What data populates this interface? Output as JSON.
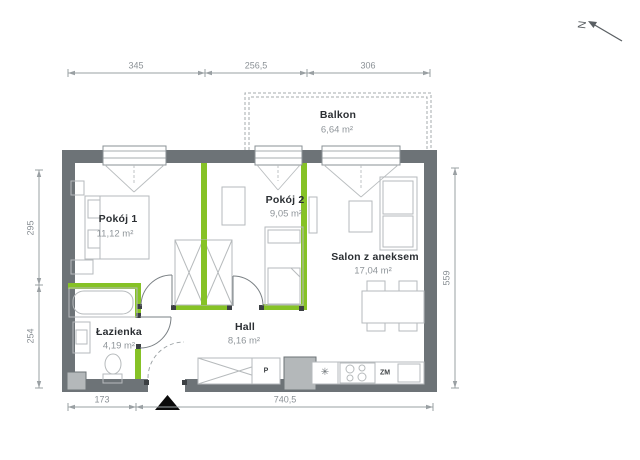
{
  "compass": {
    "label": "N"
  },
  "rooms": {
    "pokoj1": {
      "name": "Pokój 1",
      "area": "11,12 m²"
    },
    "pokoj2": {
      "name": "Pokój 2",
      "area": "9,05 m²"
    },
    "salon": {
      "name": "Salon z aneksem",
      "area": "17,04 m²"
    },
    "lazienka": {
      "name": "Łazienka",
      "area": "4,19 m²"
    },
    "hall": {
      "name": "Hall",
      "area": "8,16 m²"
    },
    "balkon": {
      "name": "Balkon",
      "area": "6,64 m²"
    }
  },
  "dimensions_cm": {
    "top": [
      "345",
      "256,5",
      "306"
    ],
    "left": [
      "295",
      "254"
    ],
    "right": [
      "559"
    ],
    "bottom": [
      "173",
      "740,5"
    ]
  },
  "fixtures": {
    "washing_machine": "P",
    "dishwasher": "ZM",
    "fridge_symbol": "✳"
  },
  "colors": {
    "wall": "#6d7377",
    "partition": "#86c226",
    "furniture_line": "#b6babc",
    "dimension": "#9aa0a3",
    "label_text": "#2b2f33",
    "area_text": "#8f959a"
  }
}
